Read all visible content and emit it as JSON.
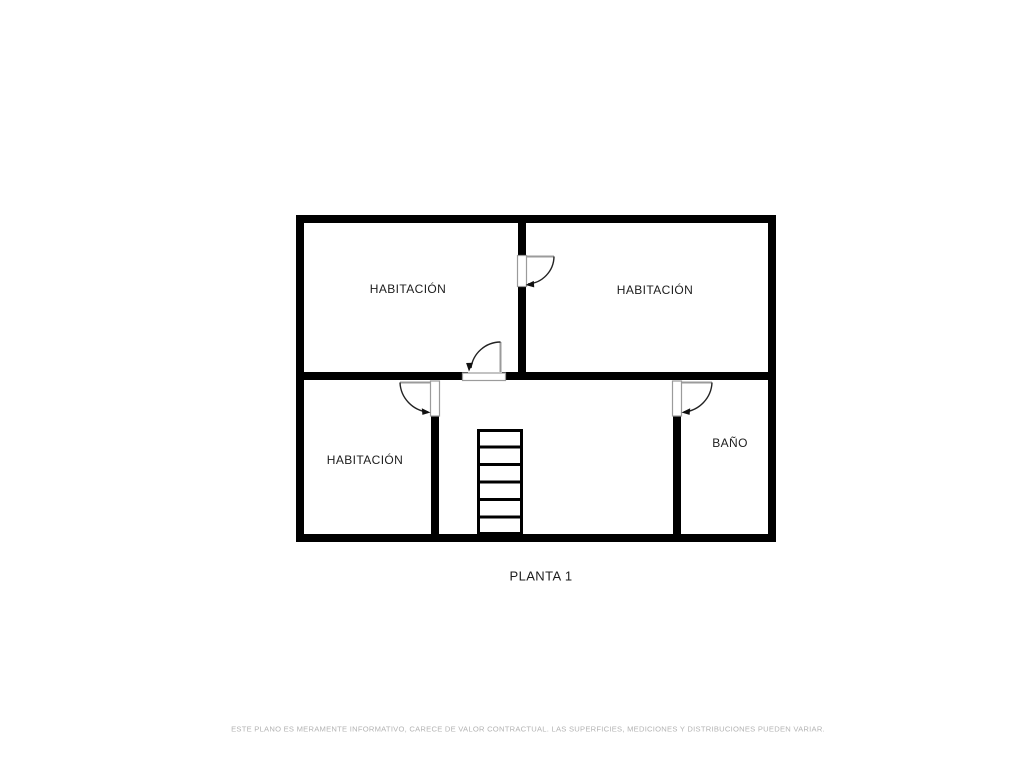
{
  "plan": {
    "floor_label": "PLANTA 1",
    "rooms": [
      {
        "id": "bedroom-top-left",
        "label": "HABITACIÓN"
      },
      {
        "id": "bedroom-top-right",
        "label": "HABITACIÓN"
      },
      {
        "id": "bedroom-bottom-left",
        "label": "HABITACIÓN"
      },
      {
        "id": "bathroom",
        "label": "BAÑO"
      }
    ],
    "features": {
      "door_count": 4,
      "stair_steps": 6
    }
  },
  "footer": {
    "disclaimer": "ESTE PLANO ES MERAMENTE INFORMATIVO, CARECE DE VALOR CONTRACTUAL. LAS SUPERFICIES, MEDICIONES Y DISTRIBUCIONES PUEDEN VARIAR."
  },
  "colors": {
    "background": "#ffffff",
    "wall": "#000000",
    "door_outline": "#9b9b9b",
    "arc_stroke": "#222222",
    "label_text": "#1c1c1c",
    "disclaimer_text": "#b3b3b3"
  }
}
